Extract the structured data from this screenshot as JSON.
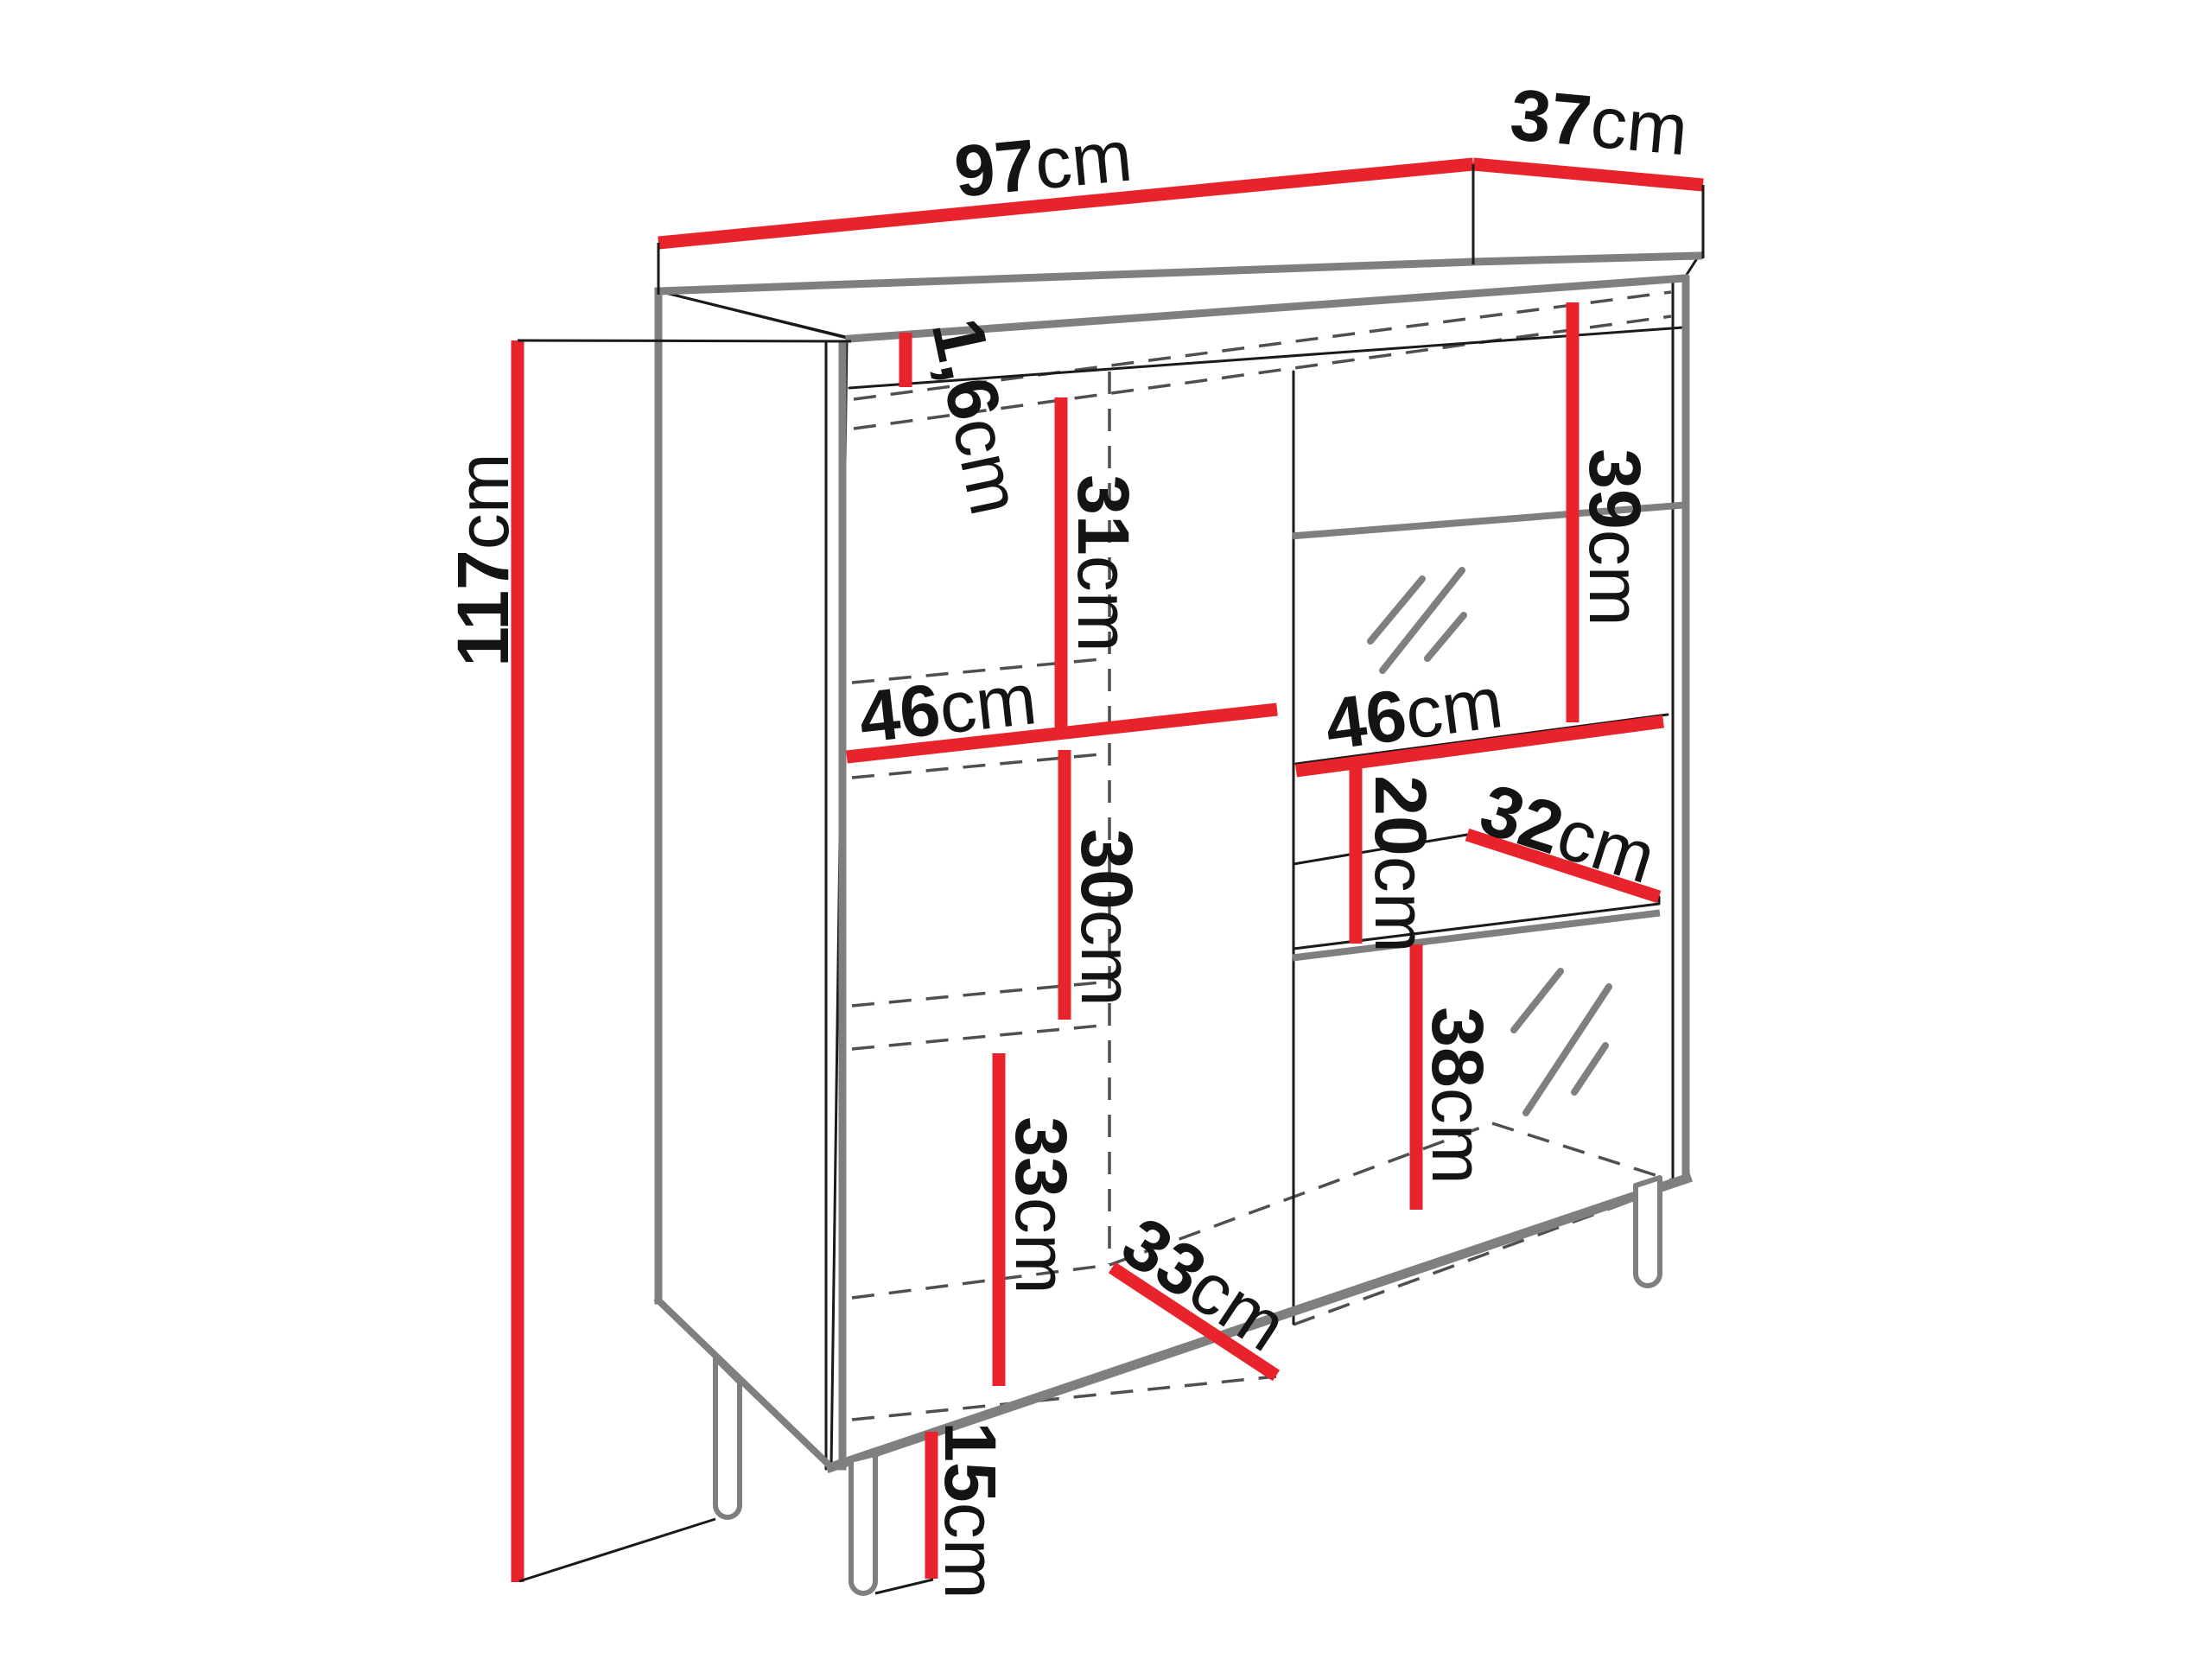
{
  "diagram": {
    "kind": "furniture-dimension-diagram",
    "subject": "display cabinet with legs, two sections and glass shelves",
    "unit": "cm",
    "colors": {
      "dimension_line": "#e8232b",
      "outline": "#1a1a1a",
      "edge_highlight": "#7f7f7f",
      "hidden_line": "#4f4f4f",
      "background": "#ffffff",
      "label_text": "#141414"
    }
  },
  "dimensions": {
    "overall_width": {
      "value": "97",
      "unit": "cm"
    },
    "overall_depth": {
      "value": "37",
      "unit": "cm"
    },
    "top_panel_thickness": {
      "value": "1,6",
      "unit": "cm"
    },
    "overall_height": {
      "value": "117",
      "unit": "cm"
    },
    "left_top_compartment": {
      "value": "31",
      "unit": "cm"
    },
    "left_shelf_width": {
      "value": "46",
      "unit": "cm"
    },
    "left_middle_compartment": {
      "value": "30",
      "unit": "cm"
    },
    "left_bottom_compartment": {
      "value": "33",
      "unit": "cm"
    },
    "interior_depth": {
      "value": "33",
      "unit": "cm"
    },
    "right_top_compartment": {
      "value": "39",
      "unit": "cm"
    },
    "right_shelf_width": {
      "value": "46",
      "unit": "cm"
    },
    "right_small_compartment": {
      "value": "20",
      "unit": "cm"
    },
    "right_shelf_depth": {
      "value": "32",
      "unit": "cm"
    },
    "right_bottom_compartment": {
      "value": "38",
      "unit": "cm"
    },
    "leg_height": {
      "value": "15",
      "unit": "cm"
    }
  }
}
